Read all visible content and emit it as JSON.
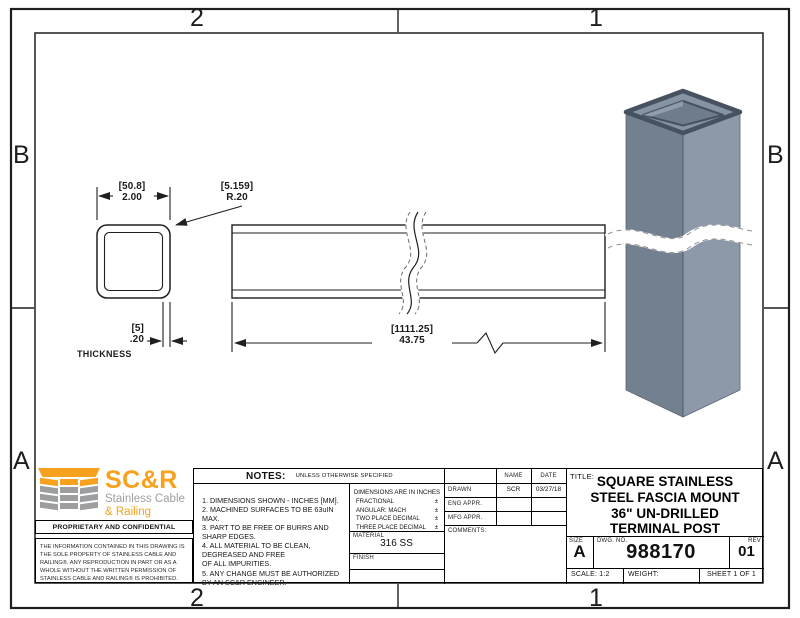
{
  "zones": {
    "top_left": "2",
    "top_right": "1",
    "bottom_left": "2",
    "bottom_right": "1",
    "left_top": "B",
    "left_bottom": "A",
    "right_top": "B",
    "right_bottom": "A"
  },
  "drawing": {
    "width_dim": {
      "mm": "[50.8]",
      "in": "2.00"
    },
    "radius_dim": {
      "mm": "[5.159]",
      "in": "R.20"
    },
    "thickness_dim": {
      "mm": "[5]",
      "in": ".20",
      "label": "THICKNESS"
    },
    "length_dim": {
      "mm": "[1111.25]",
      "in": "43.75"
    }
  },
  "logo": {
    "brand": "SC&R",
    "tagline1": "Stainless Cable",
    "tagline2": "& Railing"
  },
  "proprietary": {
    "heading": "PROPRIETARY AND CONFIDENTIAL",
    "body": "THE INFORMATION CONTAINED IN THIS DRAWING IS THE SOLE PROPERTY OF STAINLESS CABLE AND RAILING®. ANY REPRODUCTION IN PART OR AS A WHOLE WITHOUT THE WRITTEN PERMISSION OF STAINLESS CABLE AND RAILING® IS PROHIBITED."
  },
  "notes": {
    "heading": "NOTES:",
    "qualifier": "UNLESS OTHERWISE SPECIFIED",
    "body": "1. DIMENSIONS SHOWN - INCHES [MM].\n2. MACHINED SURFACES TO BE 63uIN\nMAX.\n3. PART TO BE FREE OF BURRS AND\nSHARP EDGES.\n4. ALL MATERIAL TO BE CLEAN,\nDEGREASED AND FREE\nOF ALL IMPURITIES.\n5. ANY CHANGE MUST BE AUTHORIZED\nBY AN SC&R ENGINEER."
  },
  "tolerances": {
    "heading": "DIMENSIONS ARE IN INCHES",
    "rows": [
      {
        "label": "FRACTIONAL",
        "pm": "±"
      },
      {
        "label": "ANGULAR: MACH",
        "pm": "±"
      },
      {
        "label": "TWO PLACE DECIMAL",
        "pm": "±"
      },
      {
        "label": "THREE PLACE DECIMAL",
        "pm": "±"
      }
    ]
  },
  "material": {
    "label": "MATERIAL",
    "value": "316 SS"
  },
  "finish": {
    "label": "FINISH",
    "value": ""
  },
  "approvals": {
    "name_header": "NAME",
    "date_header": "DATE",
    "rows": [
      {
        "label": "DRAWN",
        "name": "SCR",
        "date": "03/27/18"
      },
      {
        "label": "ENG APPR.",
        "name": "",
        "date": ""
      },
      {
        "label": "MFG APPR.",
        "name": "",
        "date": ""
      }
    ],
    "comments_label": "COMMENTS:"
  },
  "title_block": {
    "title_label": "TITLE:",
    "title": "SQUARE STAINLESS\nSTEEL FASCIA MOUNT\n36\" UN-DRILLED\nTERMINAL POST",
    "size_label": "SIZE",
    "size": "A",
    "dwg_label": "DWG. NO.",
    "dwg_no": "988170",
    "rev_label": "REV",
    "rev": "01",
    "scale": "SCALE: 1:2",
    "weight": "WEIGHT:",
    "sheet": "SHEET 1 OF 1"
  },
  "colors": {
    "accent_orange": "#F6A21E",
    "logo_gray": "#9C9EA0",
    "post_face_left": "#73808F",
    "post_face_right": "#8D99A8",
    "line": "#1F1F1F"
  }
}
